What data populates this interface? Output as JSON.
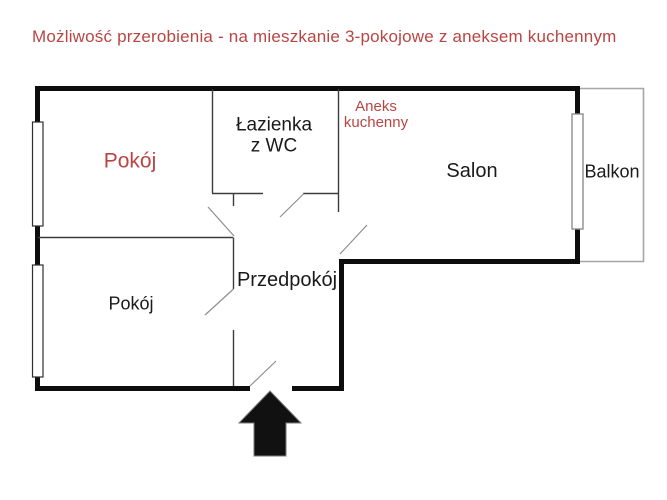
{
  "title": {
    "text": "Możliwość przerobienia - na mieszkanie 3-pokojowe z aneksem kuchennym",
    "color": "#b94543"
  },
  "colors": {
    "accent_red": "#b94543",
    "wall": "#0d0d0d",
    "partition": "#3c3c3c",
    "door_swing": "#8e8e8e",
    "balcony_outline": "#a6a6a6",
    "background": "#ffffff"
  },
  "floor_plan": {
    "rooms": {
      "pokoj_top": {
        "label": "Pokój"
      },
      "lazienka": {
        "label": "Łazienka\nz WC"
      },
      "aneks_kuchenny": {
        "label": "Aneks\nkuchenny"
      },
      "salon": {
        "label": "Salon"
      },
      "balkon": {
        "label": "Balkon"
      },
      "pokoj_bottom": {
        "label": "Pokój"
      },
      "przedpokoj": {
        "label": "Przedpokój"
      }
    },
    "entrance_icon": "arrow-up"
  }
}
